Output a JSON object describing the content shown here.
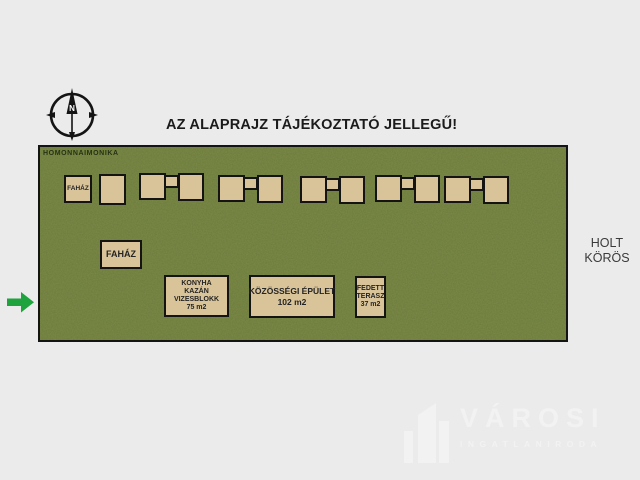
{
  "title": "AZ ALAPRAJZ TÁJÉKOZTATÓ JELLEGŰ!",
  "watermark": "HOMONNAIMONIKA",
  "compass": {
    "north": "N"
  },
  "river": {
    "line1": "HOLT",
    "line2": "KÖRÖS"
  },
  "buildings": {
    "cabin_row_label": "FAHÁZ",
    "cabin_large_label": "FAHÁZ",
    "kitchen_block": {
      "l1": "KONYHA",
      "l2": "KAZÁN",
      "l3": "VIZESBLOKK",
      "l4": "75 m2"
    },
    "community": {
      "l1": "KÖZÖSSÉGI ÉPÜLET",
      "l2": "102 m2"
    },
    "terrace": {
      "l1": "FEDETT",
      "l2": "TERASZ",
      "l3": "37 m2"
    }
  },
  "logo": {
    "brand": "VÁROSI",
    "subtitle": "INGATLANIRODA"
  },
  "icons": {
    "compass": "compass-north-icon",
    "arrow": "arrow-right-icon",
    "logo_building": "building-logo-icon"
  },
  "colors": {
    "background": "#ebebeb",
    "field_green": "#70803e",
    "building_tan": "#d9c49a",
    "outline_black": "#141414",
    "arrow_green": "#1fa33c",
    "logo_gray": "#f2f2f2",
    "river_text": "#3a3a3a"
  }
}
